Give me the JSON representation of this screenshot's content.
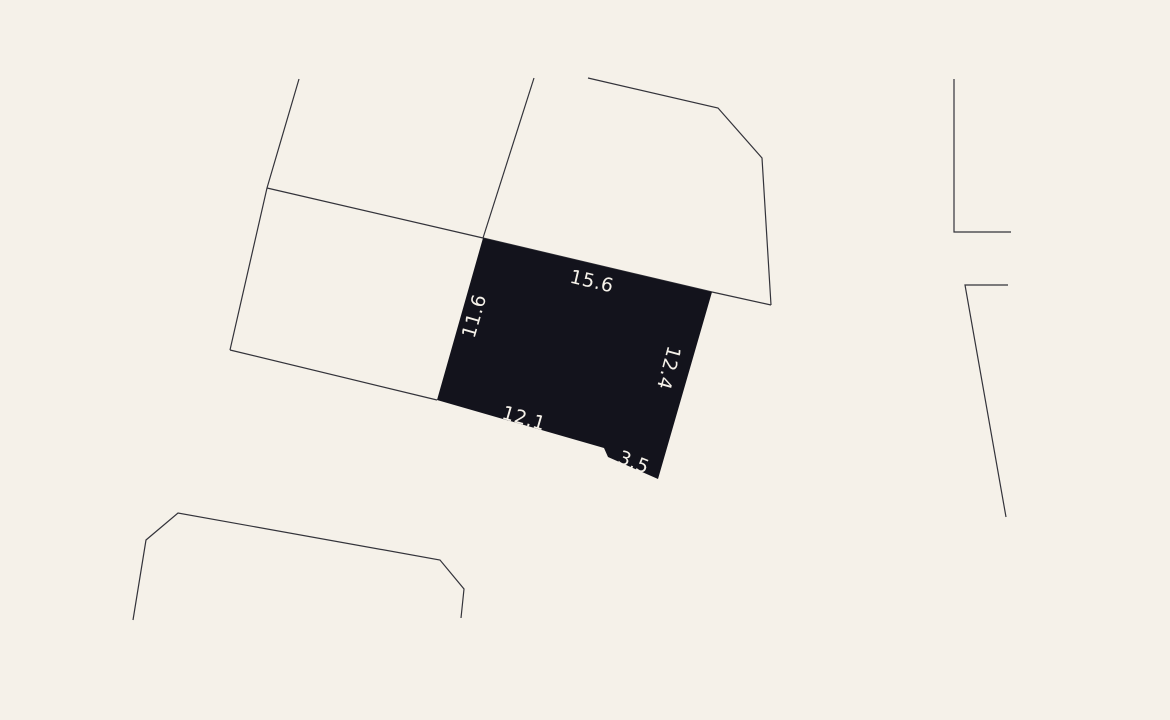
{
  "map": {
    "type": "cadastral-parcel-map",
    "colors": {
      "background": "#f5f1e9",
      "parcel_fill": "#13131c",
      "boundary": "#33333a",
      "label": "#f5f1e9"
    },
    "selected_parcel": {
      "dimensions": {
        "top": {
          "value": "15.6"
        },
        "left": {
          "value": "11.6"
        },
        "right": {
          "value": "12.4"
        },
        "bottom": {
          "value": "12.1"
        },
        "bottom_right": {
          "value": "3.5"
        }
      }
    }
  }
}
